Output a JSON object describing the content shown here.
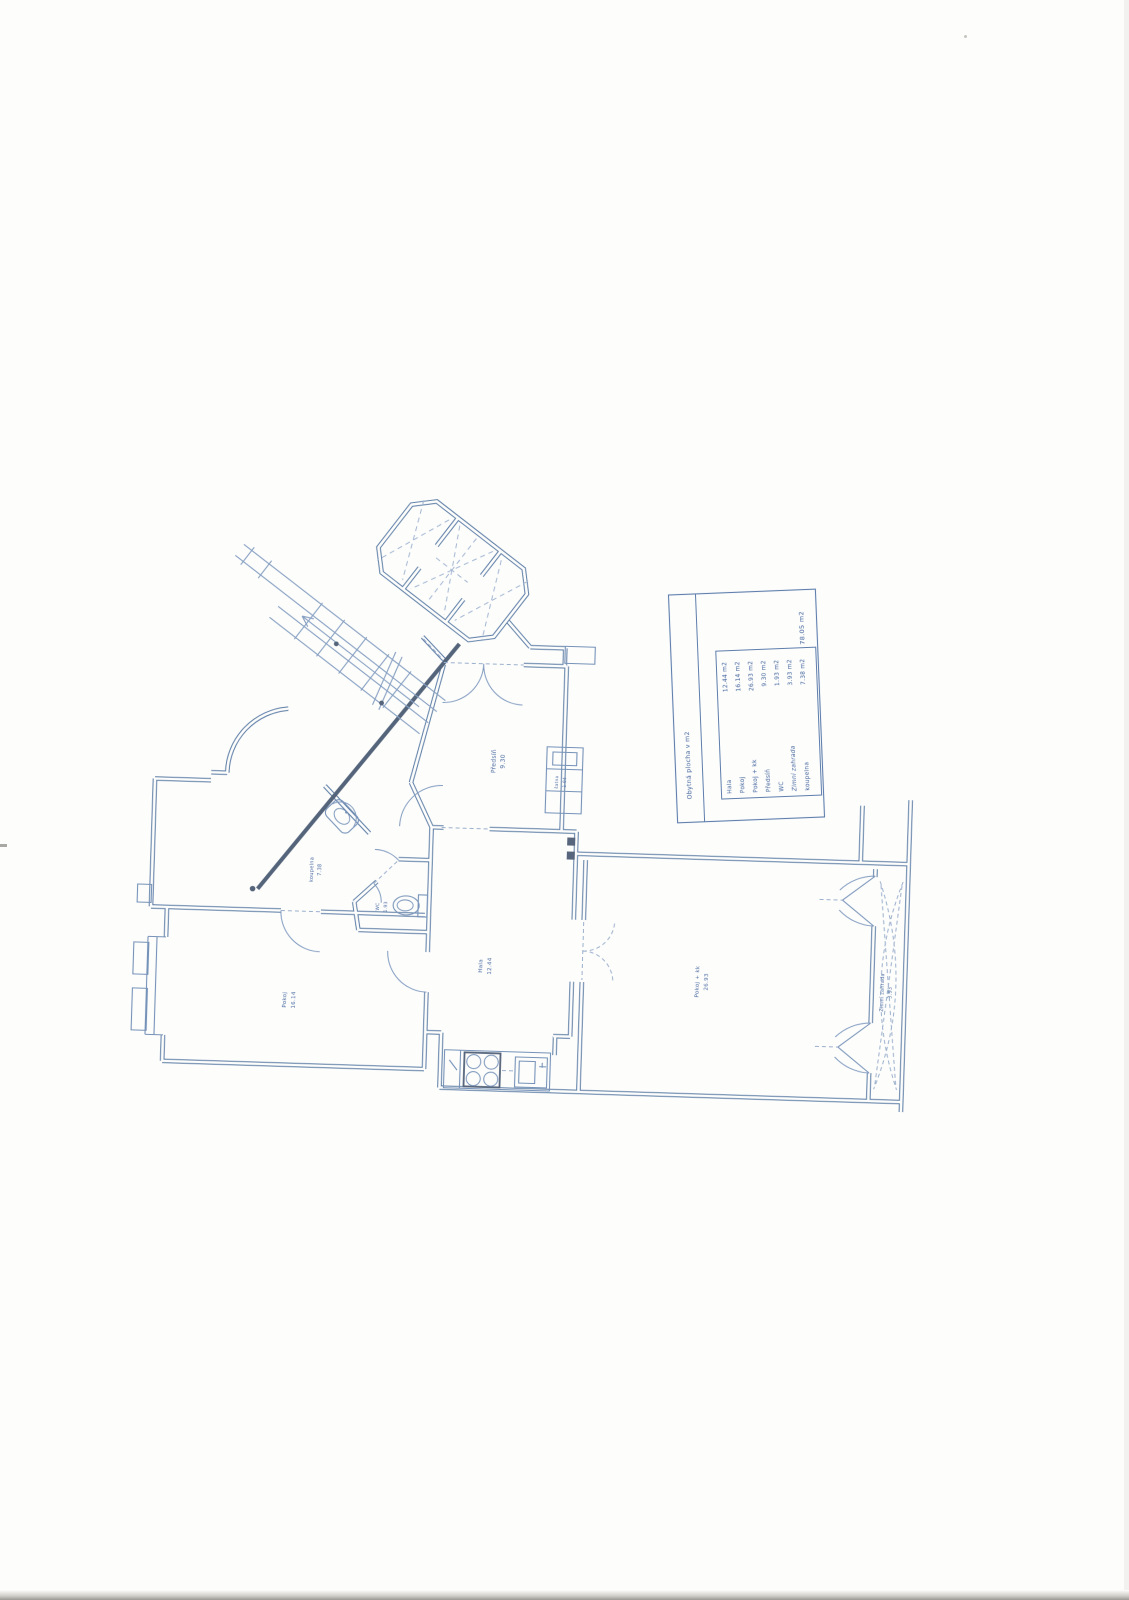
{
  "document": {
    "kind": "scanned apartment floor plan",
    "total_area": "78.05 m2"
  },
  "colors": {
    "ink": "#51749f",
    "ink_light": "#7f9abe",
    "ink_dark": "#4b5b73",
    "label_text": "#40639c",
    "paper": "#fdfdfc"
  },
  "legend": {
    "title": "Obytná plocha v m2",
    "total": "78.05 m2",
    "rows": [
      {
        "label": "Hala",
        "area": "12.44 m2"
      },
      {
        "label": "Pokoj",
        "area": "16.14 m2"
      },
      {
        "label": "Pokoj + kk",
        "area": "26.93 m2"
      },
      {
        "label": "Předsíň",
        "area": "9.30 m2"
      },
      {
        "label": "WC",
        "area": "1.93 m2"
      },
      {
        "label": "Zimní zahrada",
        "area": "3.93 m2"
      },
      {
        "label": "koupelna",
        "area": "7.38 m2"
      }
    ]
  },
  "rooms": {
    "predsin": {
      "name": "Předsíň",
      "area": "9.30"
    },
    "satna": {
      "name": "šatna",
      "area": "1.04"
    },
    "koupelna": {
      "name": "koupelna",
      "area": "7.38"
    },
    "wc": {
      "name": "WC",
      "area": "1.93"
    },
    "hala": {
      "name": "Hala",
      "area": "12.44"
    },
    "pokoj": {
      "name": "Pokoj",
      "area": "16.14"
    },
    "pokoj_kk": {
      "name": "Pokoj + kk",
      "area": "26.93"
    },
    "zimni": {
      "name": "Zimní zahrada",
      "area": "3.93"
    }
  }
}
